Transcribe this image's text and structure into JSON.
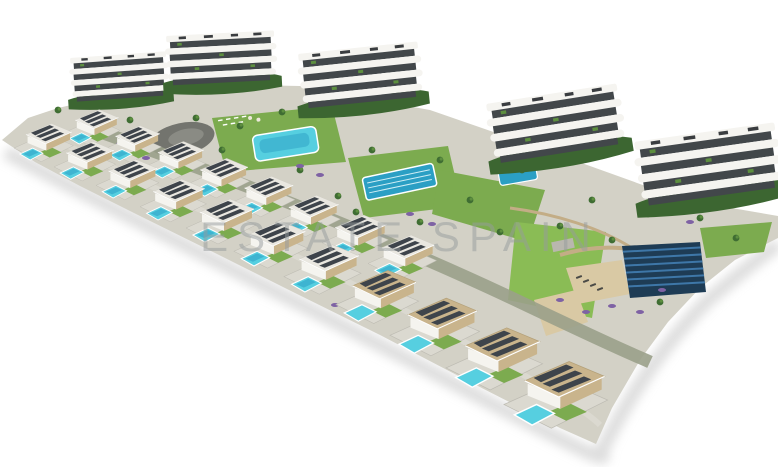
{
  "image": {
    "kind": "aerial 3d architectural render",
    "subject": "residential development with apartment blocks, villas with private pools, communal pools, gardens and solar field",
    "background": "#ffffff"
  },
  "watermark": {
    "text": "ESTATE SPAIN",
    "color": "#979c9e",
    "opacity": "0.5"
  },
  "palette": {
    "ground": "#d3d1c6",
    "path": "#dbd9d0",
    "lawn": "#7cab4f",
    "lawn_bright": "#8abc55",
    "slope": "#9aa089",
    "pool_light": "#56cfe0",
    "pool_mid": "#2b9fc4",
    "glass": "#42474a",
    "building_white": "#f5f4f0",
    "roof_white": "#e9e7e0",
    "planting": "#3c6631",
    "tree": "#3f6d33",
    "shrub_purple": "#7e62a4",
    "stone": "#c3ad86",
    "sand": "#d9c9a4",
    "plaza": "#73746e",
    "solar_navy": "#1e3c55",
    "solar_stripe": "#3e77a8",
    "villa_roof_dark": "#3e444b",
    "villa_wall": "#f5f4ef",
    "villa_tan": "#c9b48c",
    "shadow": "#d3d3d3"
  }
}
